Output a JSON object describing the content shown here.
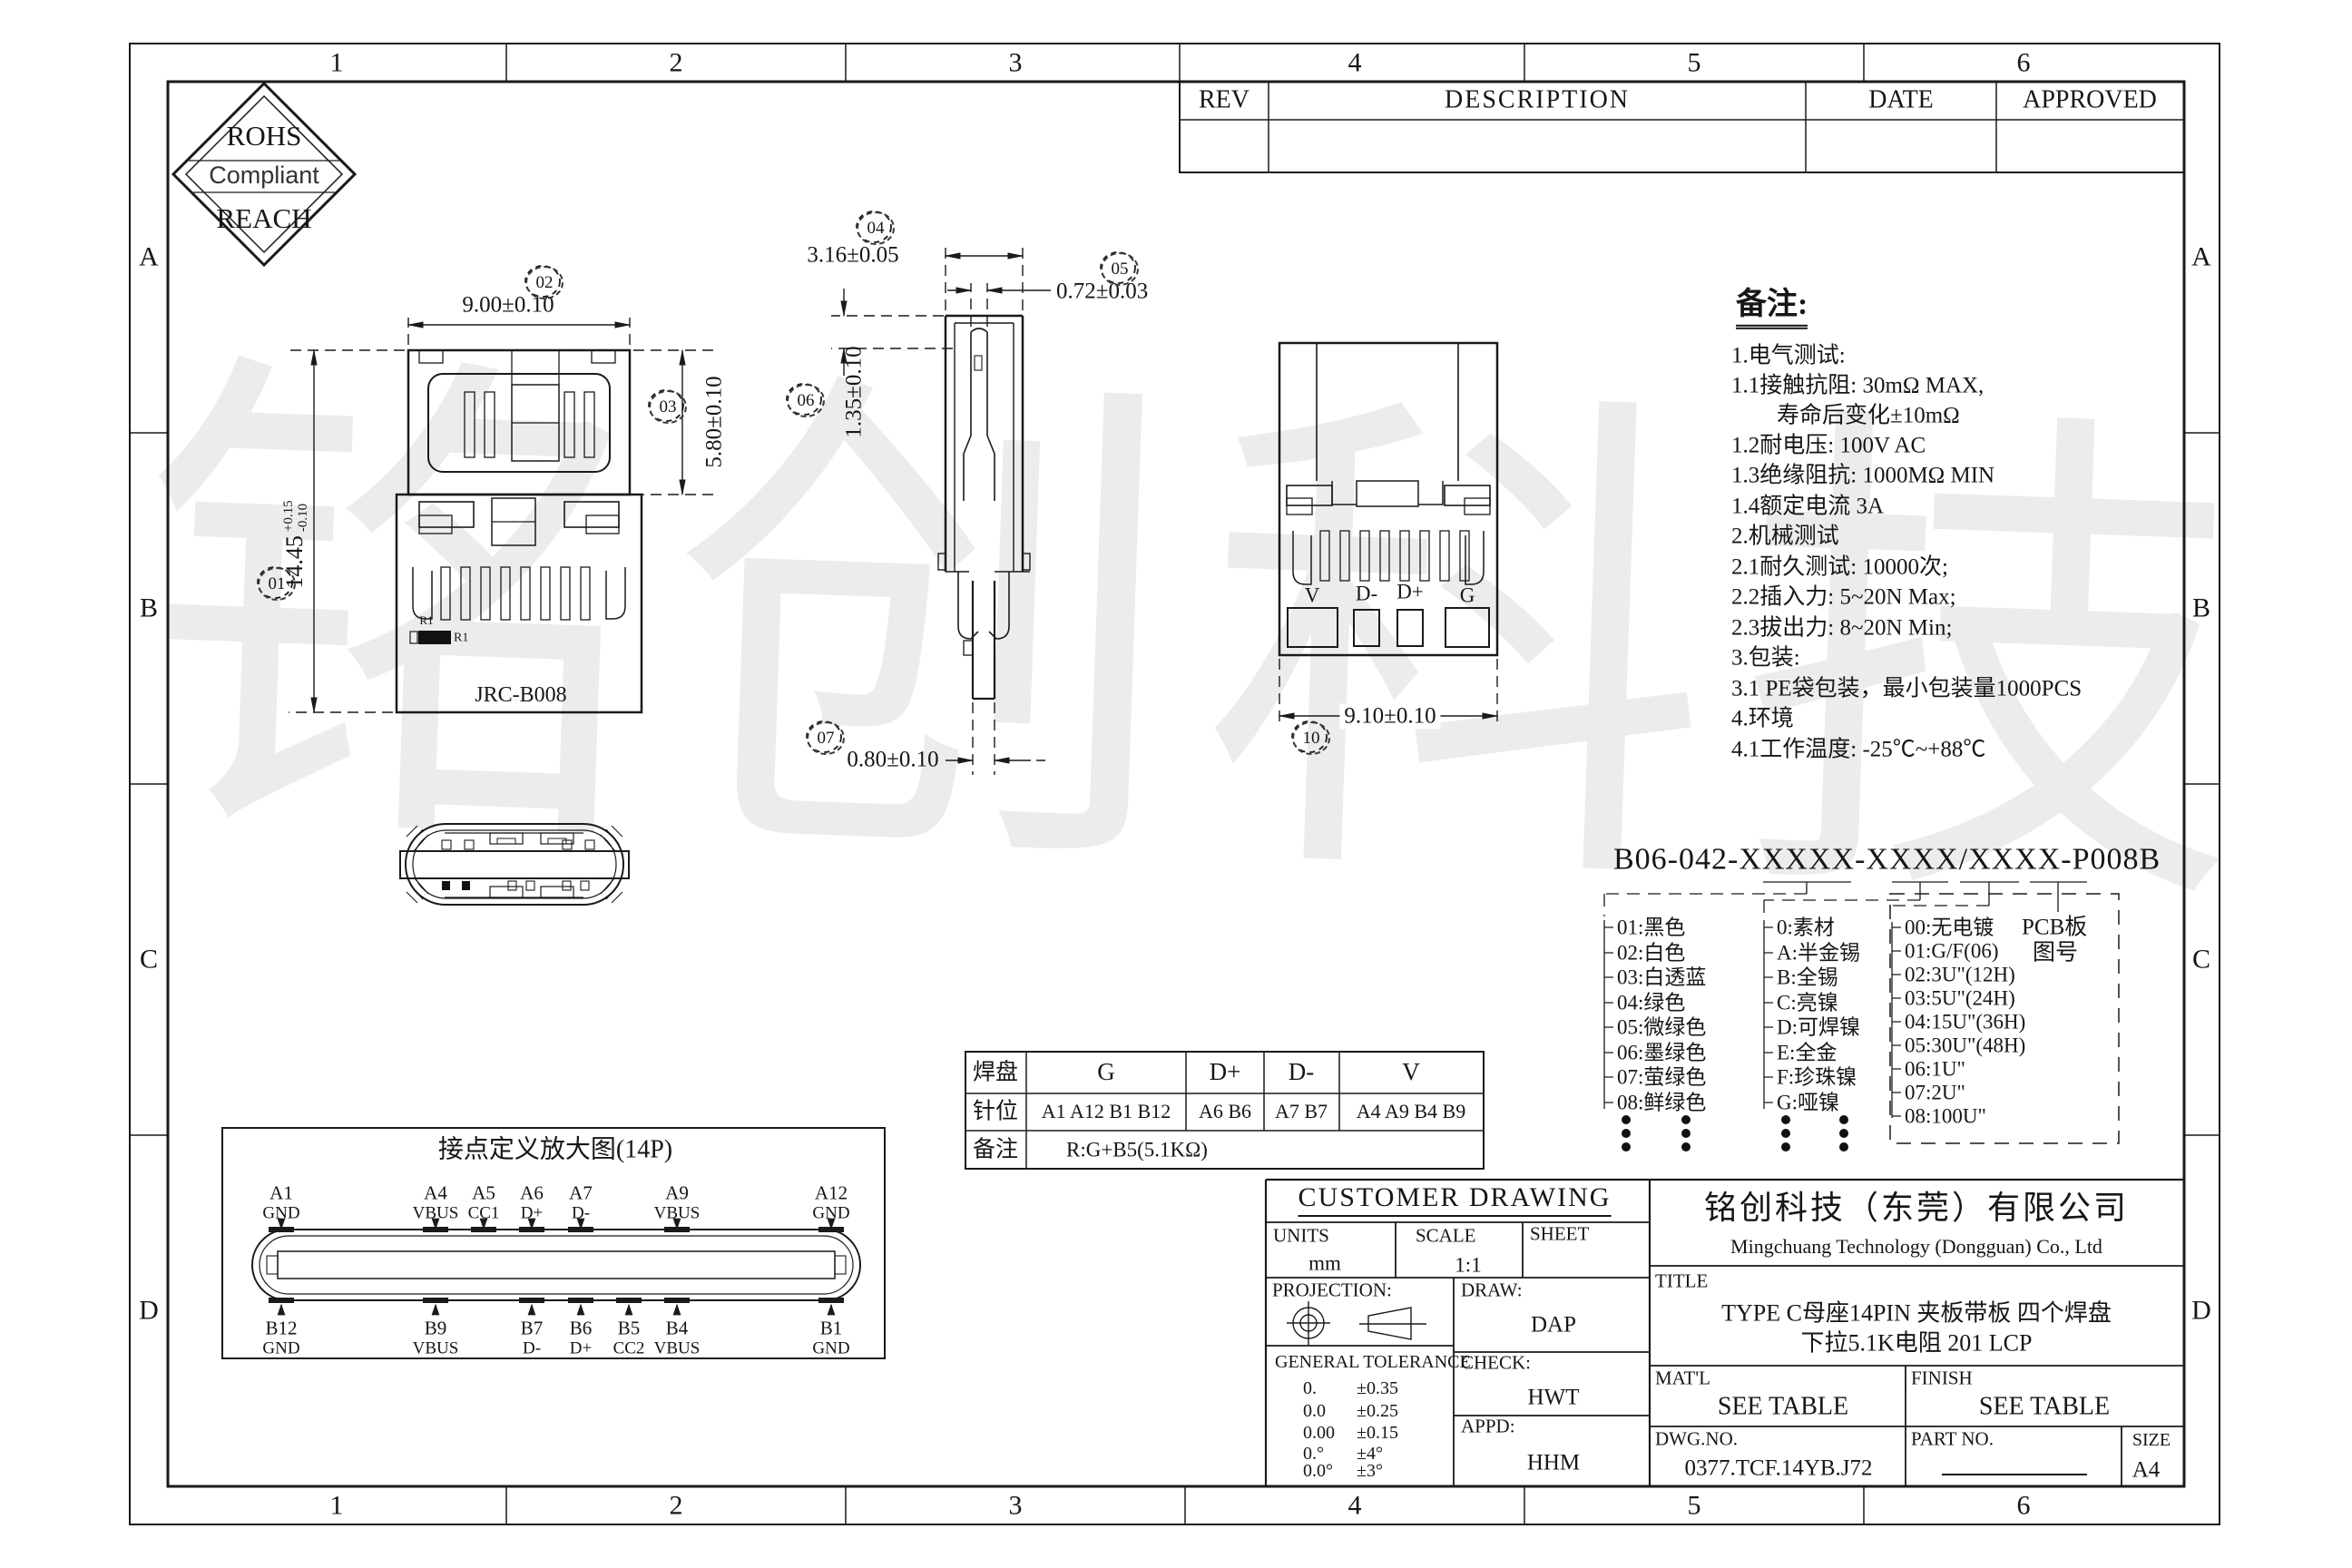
{
  "sheet": {
    "columns": [
      "1",
      "2",
      "3",
      "4",
      "5",
      "6"
    ],
    "rows": [
      "A",
      "B",
      "C",
      "D"
    ],
    "watermark": "铭创科技"
  },
  "rev_table": {
    "rev": "REV",
    "description": "DESCRIPTION",
    "date": "DATE",
    "approved": "APPROVED"
  },
  "rohs": {
    "top": "ROHS",
    "middle": "Compliant",
    "bottom": "REACH"
  },
  "views": {
    "front": {
      "dim_width": "9.00±0.10",
      "dim_shell": "5.80±0.10",
      "dim_height_main": "14.45",
      "dim_height_plus": "+0.15",
      "dim_height_minus": "-0.10",
      "balloon_01": "01",
      "balloon_02": "02",
      "balloon_03": "03",
      "body_label": "JRC-B008",
      "r1_small": "R1",
      "r1_label": "R1"
    },
    "side": {
      "dim_top": "3.16±0.05",
      "dim_pin": "0.72±0.03",
      "dim_depth": "1.35±0.10",
      "dim_tail": "0.80±0.10",
      "balloon_04": "04",
      "balloon_05": "05",
      "balloon_06": "06",
      "balloon_07": "07"
    },
    "back": {
      "pads": [
        "V",
        "D-",
        "D+",
        "G"
      ],
      "dim_width": "9.10±0.10",
      "balloon_10": "10"
    }
  },
  "notes": {
    "title": "备注:",
    "lines": [
      "1.电气测试:",
      "1.1接触抗阻: 30mΩ MAX,",
      "寿命后变化±10mΩ",
      "1.2耐电压: 100V AC",
      "1.3绝缘阻抗: 1000MΩ MIN",
      "1.4额定电流 3A",
      "2.机械测试",
      "2.1耐久测试: 10000次;",
      "2.2插入力: 5~20N Max;",
      "2.3拔出力: 8~20N Min;",
      "3.包装:",
      "3.1 PE袋包装，最小包装量1000PCS",
      "4.环境",
      "4.1工作温度: -25℃~+88℃"
    ]
  },
  "part_number": {
    "code": "B06-042-XXXXX-XXXX/XXXX-P008B",
    "colors": [
      "01:黑色",
      "02:白色",
      "03:白透蓝",
      "04:绿色",
      "05:微绿色",
      "06:墨绿色",
      "07:萤绿色",
      "08:鲜绿色"
    ],
    "plating": [
      "0:素材",
      "A:半金锡",
      "B:全锡",
      "C:亮镍",
      "D:可焊镍",
      "E:全金",
      "F:珍珠镍",
      "G:哑镍"
    ],
    "thickness": [
      "00:无电镀",
      "01:G/F(06)",
      "02:3U\"(12H)",
      "03:5U\"(24H)",
      "04:15U\"(36H)",
      "05:30U\"(48H)",
      "06:1U\"",
      "07:2U\"",
      "08:100U\""
    ],
    "pcb_line1": "PCB板",
    "pcb_line2": "图号"
  },
  "pad_table": {
    "r1_head": "焊盘",
    "r1_cells": [
      "G",
      "D+",
      "D-",
      "V"
    ],
    "r2_head": "针位",
    "r2_cells": [
      "A1 A12 B1 B12",
      "A6 B6",
      "A7 B7",
      "A4 A9 B4 B9"
    ],
    "r3_head": "备注",
    "r3_value": "R:G+B5(5.1KΩ)"
  },
  "pin_diagram": {
    "title": "接点定义放大图(14P)",
    "top_pins": [
      {
        "id": "A1",
        "sig": "GND"
      },
      {
        "id": "A4",
        "sig": "VBUS"
      },
      {
        "id": "A5",
        "sig": "CC1"
      },
      {
        "id": "A6",
        "sig": "D+"
      },
      {
        "id": "A7",
        "sig": "D-"
      },
      {
        "id": "A9",
        "sig": "VBUS"
      },
      {
        "id": "A12",
        "sig": "GND"
      }
    ],
    "bottom_pins": [
      {
        "id": "B12",
        "sig": "GND"
      },
      {
        "id": "B9",
        "sig": "VBUS"
      },
      {
        "id": "B7",
        "sig": "D-"
      },
      {
        "id": "B6",
        "sig": "D+"
      },
      {
        "id": "B5",
        "sig": "CC2"
      },
      {
        "id": "B4",
        "sig": "VBUS"
      },
      {
        "id": "B1",
        "sig": "GND"
      }
    ]
  },
  "title_block": {
    "heading": "CUSTOMER DRAWING",
    "units_label": "UNITS",
    "units_value": "mm",
    "scale_label": "SCALE",
    "scale_value": "1:1",
    "sheet_label": "SHEET",
    "projection_label": "PROJECTION:",
    "draw_label": "DRAW:",
    "draw_value": "DAP",
    "tol_title": "GENERAL TOLERANCE",
    "tolerances": [
      {
        "v": "0.",
        "t": "±0.35"
      },
      {
        "v": "0.0",
        "t": "±0.25"
      },
      {
        "v": "0.00",
        "t": "±0.15"
      },
      {
        "v": "0.°",
        "t": "±4°"
      },
      {
        "v": "0.0°",
        "t": "±3°"
      }
    ],
    "check_label": "CHECK:",
    "check_value": "HWT",
    "appd_label": "APPD:",
    "appd_value": "HHM",
    "company_cn": "铭创科技（东莞）有限公司",
    "company_en": "Mingchuang Technology (Dongguan) Co., Ltd",
    "title_label": "TITLE",
    "title_line1": "TYPE C母座14PIN 夹板带板 四个焊盘",
    "title_line2": "下拉5.1K电阻 201 LCP",
    "matl_label": "MAT'L",
    "matl_value": "SEE TABLE",
    "finish_label": "FINISH",
    "finish_value": "SEE TABLE",
    "dwg_label": "DWG.NO.",
    "dwg_value": "0377.TCF.14YB.J72",
    "part_label": "PART NO.",
    "size_label": "SIZE",
    "size_value": "A4"
  }
}
